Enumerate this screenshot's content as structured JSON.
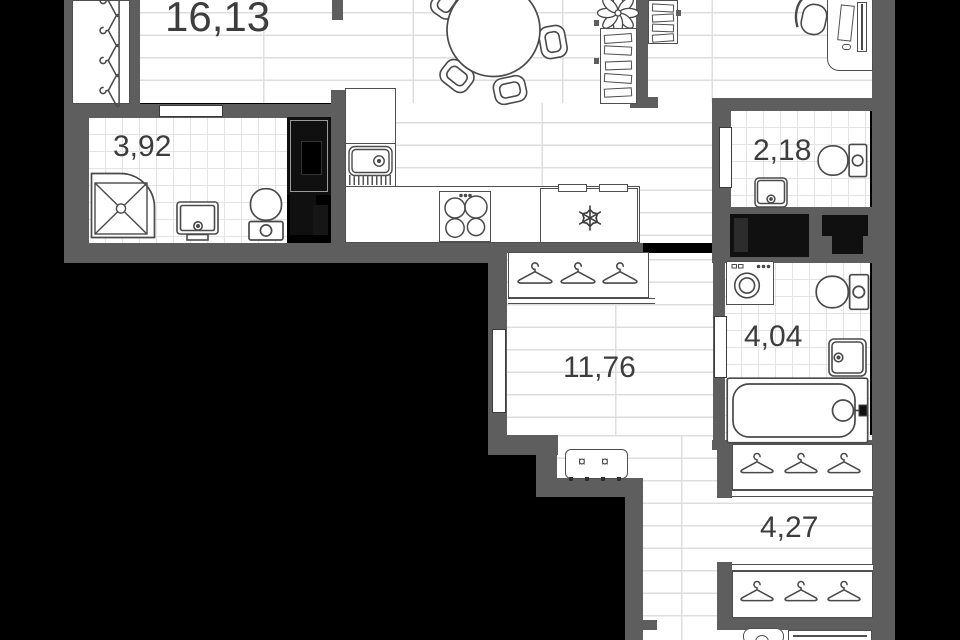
{
  "plan": {
    "rooms": [
      {
        "name": "living-room-kitchen",
        "area": "16,13"
      },
      {
        "name": "shower-room",
        "area": "3,92"
      },
      {
        "name": "wc",
        "area": "2,18"
      },
      {
        "name": "hallway",
        "area": "11,76"
      },
      {
        "name": "bathroom",
        "area": "4,04"
      },
      {
        "name": "wardrobe-corridor",
        "area": "4,27"
      }
    ],
    "icons": {
      "bench_marker": "¤",
      "fridge": "snowflake-icon",
      "wardrobe": "hanger-icon",
      "plant": "flower-icon"
    },
    "colors": {
      "wall": "#5e5e5e",
      "outside": "#000000",
      "floor": "#ffffff",
      "line": "#4a4a4a",
      "label_text": "#3d3d3d",
      "appliance_dark": "#111111",
      "plank_line": "#dedede",
      "tile_line": "#e4e4e4"
    }
  }
}
